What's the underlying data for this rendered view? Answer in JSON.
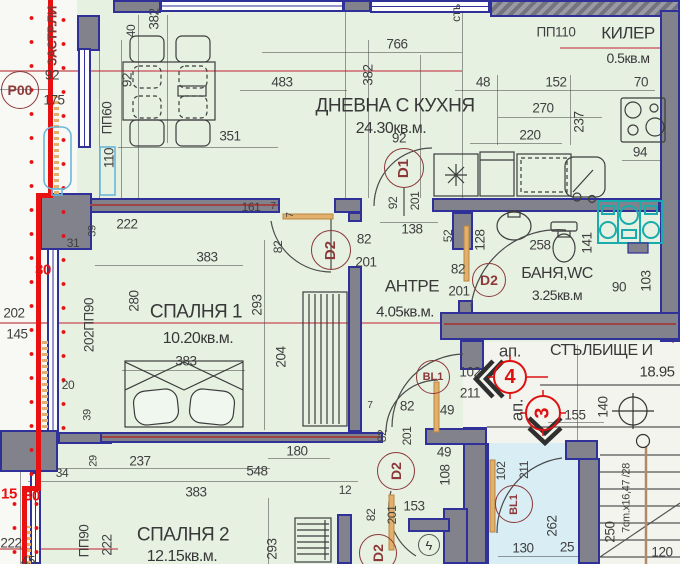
{
  "plan_title": "apartment-floor-plan",
  "rooms": {
    "living": {
      "name": "ДНЕВНА С КУХНЯ",
      "area": "24.30кв.м."
    },
    "bedroom1": {
      "name": "СПАЛНЯ 1",
      "area": "10.20кв.м."
    },
    "bedroom2": {
      "name": "СПАЛНЯ 2",
      "area": "12.15кв.м."
    },
    "hall": {
      "name": "АНТРЕ",
      "area": "4.05кв.м."
    },
    "bath": {
      "name": "БАНЯ,WC",
      "area": "3.25кв.м"
    },
    "closet": {
      "name": "КИЛЕР",
      "area": "0.5кв.м"
    },
    "stair": {
      "name": "СТЪЛБИЩЕ И",
      "area": "18.95"
    }
  },
  "palette": {
    "room_fill": "#e6f1e2",
    "wall": "#82828c",
    "wall_edge": "#303099",
    "building_line": "#e81010",
    "marker": "#8c3838",
    "apartment_circle": "#dd1111",
    "balcony_fill": "#d9edf5",
    "appliance_teal": "#1aacac",
    "section_line": "#d4888a"
  },
  "dimensions": [
    {
      "t": "766",
      "x": 397,
      "y": 44
    },
    {
      "t": "483",
      "x": 282,
      "y": 82
    },
    {
      "t": "92",
      "x": 52,
      "y": 75
    },
    {
      "t": "175",
      "x": 54,
      "y": 100
    },
    {
      "t": "351",
      "x": 230,
      "y": 136
    },
    {
      "t": "92",
      "x": 399,
      "y": 138
    },
    {
      "t": "ПП110",
      "x": 556,
      "y": 32
    },
    {
      "t": "48",
      "x": 483,
      "y": 82
    },
    {
      "t": "152",
      "x": 556,
      "y": 82
    },
    {
      "t": "270",
      "x": 543,
      "y": 108
    },
    {
      "t": "220",
      "x": 530,
      "y": 135
    },
    {
      "t": "70",
      "x": 641,
      "y": 82
    },
    {
      "t": "94",
      "x": 640,
      "y": 152
    },
    {
      "t": "138",
      "x": 412,
      "y": 229
    },
    {
      "t": "258",
      "x": 540,
      "y": 245
    },
    {
      "t": "90",
      "x": 619,
      "y": 287
    },
    {
      "t": "222",
      "x": 127,
      "y": 224
    },
    {
      "t": "31",
      "x": 73,
      "y": 243,
      "s": 12
    },
    {
      "t": "161",
      "x": 251,
      "y": 207,
      "s": 12
    },
    {
      "t": "7",
      "x": 273,
      "y": 207,
      "s": 10
    },
    {
      "t": "383",
      "x": 207,
      "y": 257
    },
    {
      "t": "383",
      "x": 186,
      "y": 361
    },
    {
      "t": "20",
      "x": 68,
      "y": 385,
      "s": 12
    },
    {
      "t": "34",
      "x": 62,
      "y": 473,
      "s": 12
    },
    {
      "t": "237",
      "x": 140,
      "y": 461
    },
    {
      "t": "548",
      "x": 257,
      "y": 471
    },
    {
      "t": "180",
      "x": 297,
      "y": 451
    },
    {
      "t": "383",
      "x": 196,
      "y": 492
    },
    {
      "t": "12",
      "x": 345,
      "y": 490,
      "s": 12
    },
    {
      "t": "202",
      "x": 14,
      "y": 313
    },
    {
      "t": "145",
      "x": 17,
      "y": 334
    },
    {
      "t": "153",
      "x": 414,
      "y": 506
    },
    {
      "t": "130",
      "x": 523,
      "y": 548
    },
    {
      "t": "25",
      "x": 567,
      "y": 547
    },
    {
      "t": "120",
      "x": 662,
      "y": 552
    },
    {
      "t": "155",
      "x": 575,
      "y": 415
    },
    {
      "t": "7",
      "x": 370,
      "y": 406,
      "s": 10
    },
    {
      "t": "82",
      "x": 407,
      "y": 406
    },
    {
      "t": "49",
      "x": 447,
      "y": 410
    },
    {
      "t": "49",
      "x": 444,
      "y": 452
    },
    {
      "t": "82",
      "x": 458,
      "y": 269
    },
    {
      "t": "201",
      "x": 459,
      "y": 291
    },
    {
      "t": "82",
      "x": 364,
      "y": 239
    },
    {
      "t": "201",
      "x": 366,
      "y": 262
    },
    {
      "t": "222",
      "x": 11,
      "y": 543
    },
    {
      "t": "45",
      "x": 28,
      "y": 561
    },
    {
      "t": "102",
      "x": 470,
      "y": 372
    },
    {
      "t": "211",
      "x": 470,
      "y": 393
    },
    {
      "t": "ап.",
      "x": 510,
      "y": 351,
      "s": 17
    },
    {
      "t": "ап.",
      "x": 517,
      "y": 410,
      "s": 17,
      "r": 1
    },
    {
      "t": "382",
      "x": 154,
      "y": 19,
      "r": 1
    },
    {
      "t": "40",
      "x": 131,
      "y": 31,
      "r": 1,
      "s": 12
    },
    {
      "t": "92",
      "x": 127,
      "y": 80,
      "r": 1
    },
    {
      "t": "ПП60",
      "x": 107,
      "y": 118,
      "r": 1
    },
    {
      "t": "110",
      "x": 109,
      "y": 158,
      "r": 1
    },
    {
      "t": "382",
      "x": 368,
      "y": 75,
      "r": 1
    },
    {
      "t": "237",
      "x": 579,
      "y": 122,
      "r": 1
    },
    {
      "t": "52",
      "x": 448,
      "y": 236,
      "r": 1,
      "s": 12
    },
    {
      "t": "128",
      "x": 480,
      "y": 240,
      "r": 1
    },
    {
      "t": "141",
      "x": 587,
      "y": 243,
      "r": 1
    },
    {
      "t": "103",
      "x": 646,
      "y": 281,
      "r": 1
    },
    {
      "t": "92",
      "x": 393,
      "y": 203,
      "r": 1,
      "s": 12
    },
    {
      "t": "201",
      "x": 415,
      "y": 201,
      "r": 1,
      "s": 12
    },
    {
      "t": "280",
      "x": 134,
      "y": 301,
      "r": 1
    },
    {
      "t": "293",
      "x": 257,
      "y": 305,
      "r": 1
    },
    {
      "t": "204",
      "x": 281,
      "y": 357,
      "r": 1
    },
    {
      "t": "202ПП90",
      "x": 89,
      "y": 325,
      "r": 1
    },
    {
      "t": "39",
      "x": 93,
      "y": 231,
      "r": 1,
      "s": 11
    },
    {
      "t": "39",
      "x": 88,
      "y": 415,
      "r": 1,
      "s": 11
    },
    {
      "t": "293",
      "x": 272,
      "y": 549,
      "r": 1
    },
    {
      "t": "222",
      "x": 107,
      "y": 545,
      "r": 1
    },
    {
      "t": "ПП90",
      "x": 84,
      "y": 541,
      "r": 1
    },
    {
      "t": "29",
      "x": 94,
      "y": 461,
      "r": 1,
      "s": 11
    },
    {
      "t": "82",
      "x": 278,
      "y": 247,
      "r": 1,
      "s": 12
    },
    {
      "t": "7",
      "x": 291,
      "y": 215,
      "r": 1,
      "s": 10
    },
    {
      "t": "140",
      "x": 603,
      "y": 407,
      "r": 1
    },
    {
      "t": "262",
      "x": 552,
      "y": 526,
      "r": 1
    },
    {
      "t": "250",
      "x": 610,
      "y": 532,
      "r": 1
    },
    {
      "t": "7cm.x16,47 /28",
      "x": 627,
      "y": 498,
      "r": 1,
      "s": 11
    },
    {
      "t": "108",
      "x": 445,
      "y": 475,
      "r": 1
    },
    {
      "t": "82",
      "x": 382,
      "y": 436,
      "r": 1,
      "s": 12
    },
    {
      "t": "201",
      "x": 407,
      "y": 436,
      "r": 1,
      "s": 12
    },
    {
      "t": "82",
      "x": 371,
      "y": 515,
      "r": 1,
      "s": 12
    },
    {
      "t": "201",
      "x": 392,
      "y": 515,
      "r": 1,
      "s": 12
    },
    {
      "t": "102",
      "x": 501,
      "y": 471,
      "r": 1,
      "s": 12
    },
    {
      "t": "211",
      "x": 524,
      "y": 470,
      "r": 1,
      "s": 12
    },
    {
      "t": "стъ",
      "x": 456,
      "y": 13,
      "r": 1,
      "s": 12
    },
    {
      "t": "30",
      "x": 43,
      "y": 270,
      "c": "red",
      "s": 15
    },
    {
      "t": "15",
      "x": 9,
      "y": 494,
      "c": "red",
      "s": 15
    },
    {
      "t": "30",
      "x": 32,
      "y": 496,
      "c": "red",
      "s": 15
    },
    {
      "t": "ЗАСТР.ЛИ",
      "x": 52,
      "y": 36,
      "r": 1,
      "c": "maroon",
      "s": 13
    }
  ],
  "markers": [
    {
      "t": "Р00",
      "x": 20,
      "y": 90,
      "d": 38,
      "s": 14
    },
    {
      "t": "D1",
      "x": 404,
      "y": 168,
      "d": 40,
      "s": 15,
      "r": 1
    },
    {
      "t": "D2",
      "x": 331,
      "y": 250,
      "d": 40,
      "s": 15,
      "r": 1
    },
    {
      "t": "D2",
      "x": 489,
      "y": 280,
      "d": 34,
      "s": 14
    },
    {
      "t": "D2",
      "x": 396,
      "y": 471,
      "d": 38,
      "s": 14,
      "r": 1
    },
    {
      "t": "D2",
      "x": 378,
      "y": 553,
      "d": 38,
      "s": 14,
      "r": 1
    },
    {
      "t": "BL1",
      "x": 433,
      "y": 377,
      "d": 34,
      "s": 11
    },
    {
      "t": "BL1",
      "x": 514,
      "y": 504,
      "d": 38,
      "s": 11,
      "r": 1
    },
    {
      "t": "4",
      "x": 510,
      "y": 377,
      "d": 34,
      "s": 20,
      "c": "red"
    },
    {
      "t": "3",
      "x": 543,
      "y": 413,
      "d": 36,
      "s": 20,
      "c": "red",
      "r": 1
    },
    {
      "t": "ϟ",
      "x": 429,
      "y": 545,
      "d": 22,
      "s": 13,
      "c": "gray"
    }
  ]
}
